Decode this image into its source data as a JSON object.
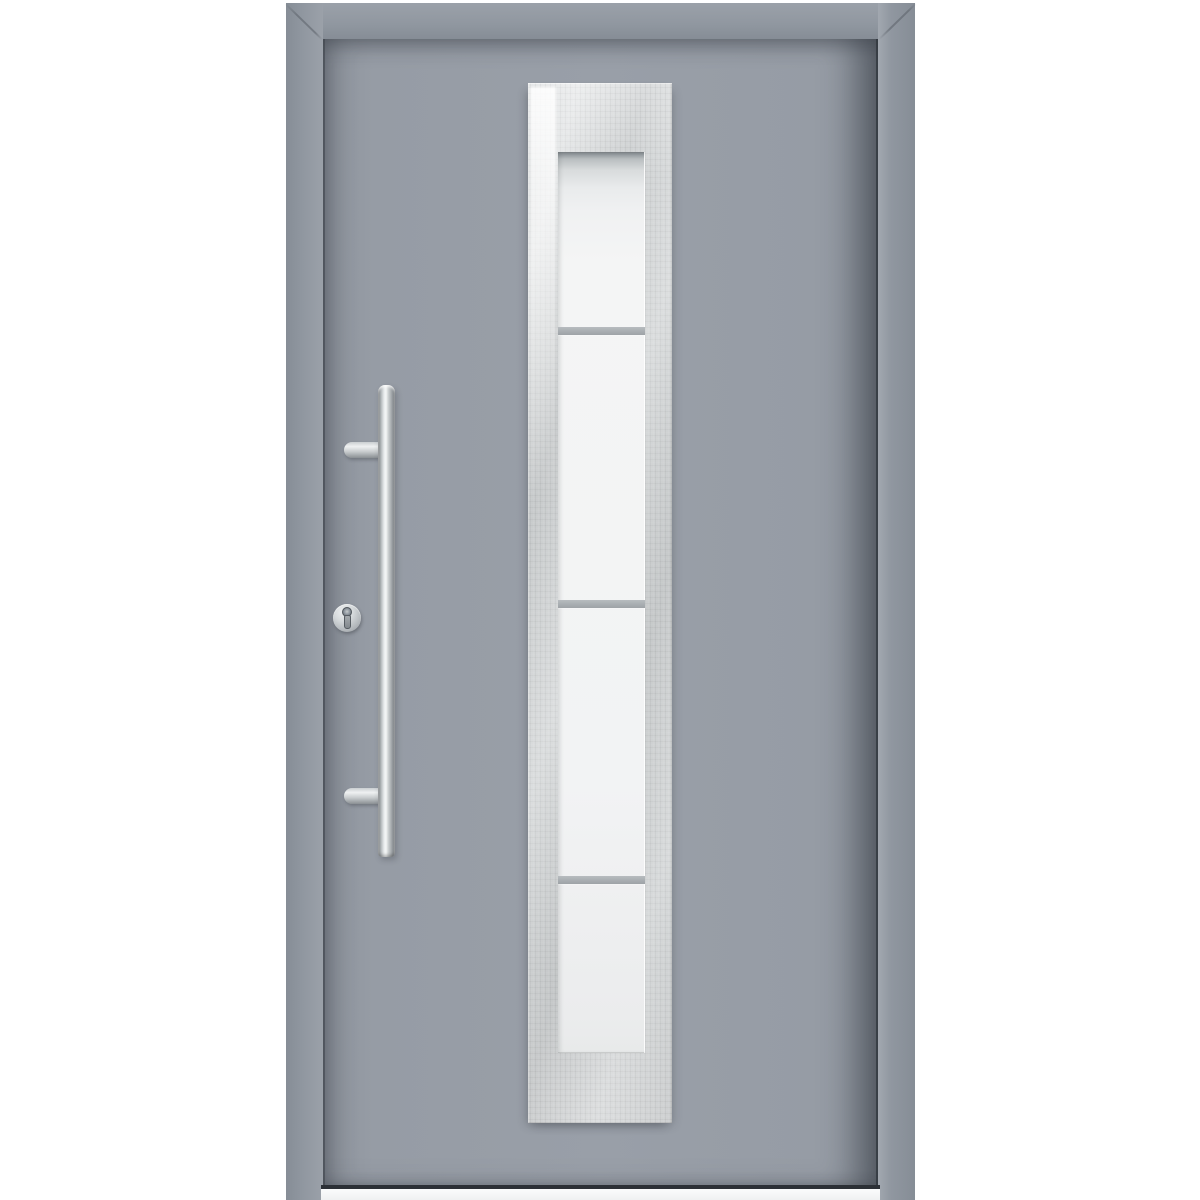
{
  "scene": {
    "description": "Product photo of a modern grey aluminium front entry door, shown closed in its frame on a white background",
    "background": "white"
  },
  "door": {
    "frame": "grey aluminium frame with mitred top corners",
    "leaf": "plain grey aluminium leaf",
    "threshold": "light aluminium threshold strip at the bottom",
    "glazing": {
      "panel_material": "brushed stainless steel",
      "glass_finish": "frosted white",
      "section_count": 4,
      "bar_count": 3,
      "bar_positions_px": [
        327,
        600,
        876
      ]
    },
    "hardware": {
      "handle": "vertical stainless-steel bar pull handle",
      "handle_mount_count": 2,
      "lock": "euro-profile cylinder lock with round stainless escutcheon"
    }
  },
  "colors": {
    "bg": "#ffffff",
    "frame": "#9097a0",
    "frame-dark": "#868d96",
    "frame-light": "#9ba1a9",
    "leaf": "#969ca5",
    "leaf-edge-dark": "#4b5057",
    "steel-base": "#d2d5d6",
    "steel-light": "#e4e6e7",
    "steel-dark": "#c5c8ca",
    "glass": "#f2f3f4",
    "glass-top-shadow": "#7d8387",
    "glazing-bar": "#a8adb1",
    "chrome-light": "#f4f6f6",
    "chrome-mid": "#c9cdce",
    "chrome-dark": "#7e8285",
    "threshold-line": "#2c3036",
    "threshold-strip": "#eff1f2"
  }
}
